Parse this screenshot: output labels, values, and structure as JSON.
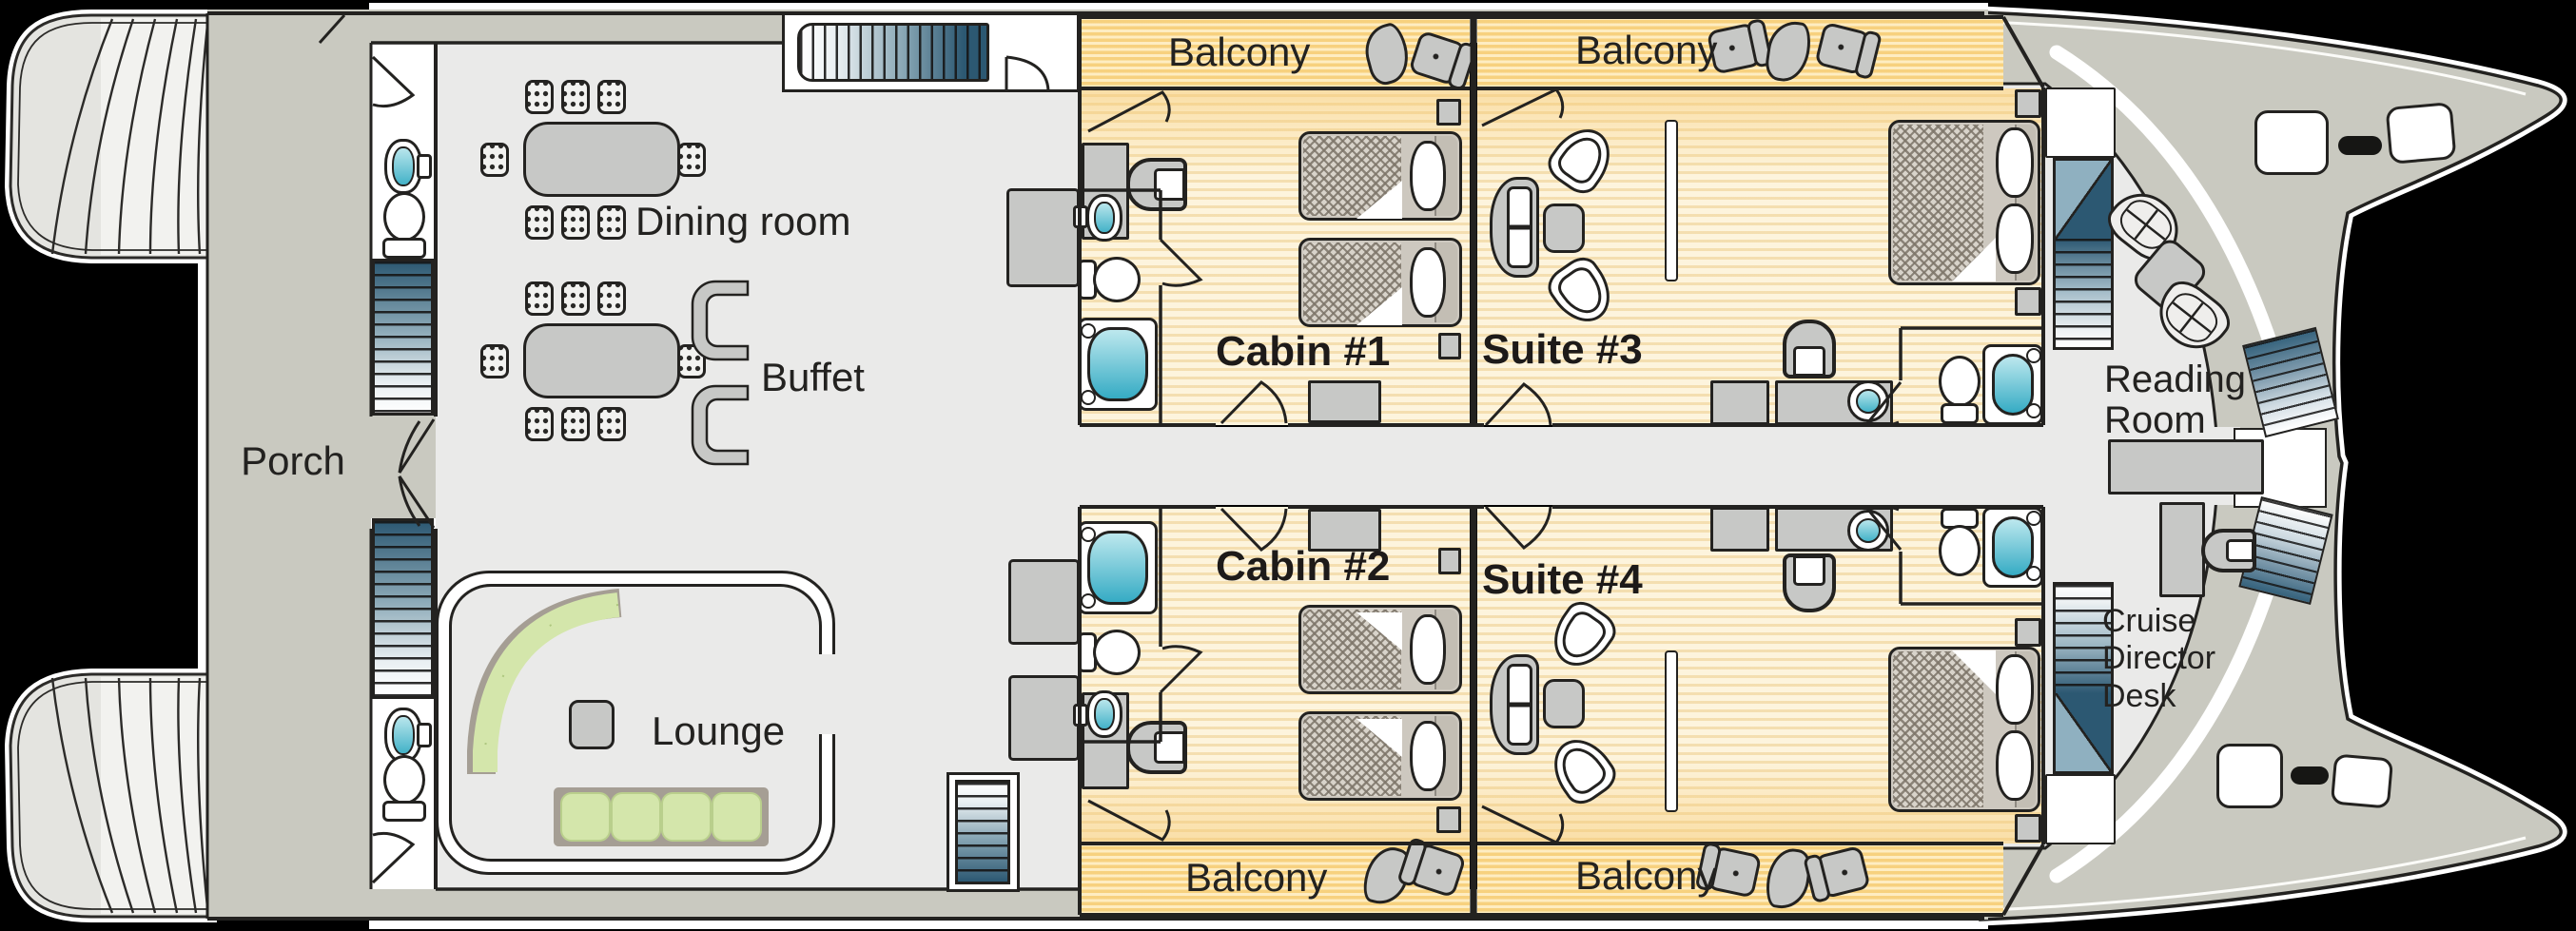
{
  "rooms": {
    "porch": "Porch",
    "dining_room": "Dining room",
    "buffet": "Buffet",
    "lounge": "Lounge",
    "cabin_1": "Cabin #1",
    "cabin_2": "Cabin #2",
    "suite_3": "Suite #3",
    "suite_4": "Suite #4",
    "reading_room": "Reading Room",
    "cruise_director_desk": "Cruise Director Desk"
  },
  "balconies": {
    "cabin_1": "Balcony",
    "suite_3": "Balcony",
    "cabin_2": "Balcony",
    "suite_4": "Balcony"
  },
  "colors": {
    "background": "#000000",
    "deck": "#c9c9c0",
    "hull": "#e4e4e0",
    "public_floor": "#eaeae9",
    "cabin_floor": "#fdf4dd",
    "balcony_floor": "#fbdf9e",
    "water_fixture": "#43b2c8",
    "stairs_dark": "#2c5872",
    "sofa_green": "#d4e6ab",
    "furniture_gray": "#c7c8c6",
    "outline": "#232220"
  },
  "symbols": {
    "staircase": "gradient-tread-strip",
    "bed": "chevron-mattress-with-pillow",
    "toilet": "tank-and-bowl",
    "sink": "cyan-basin",
    "bathtub": "cyan-rounded-tub",
    "dining_chair": "nine-dot-square",
    "deck_chair": "four-dot-square-with-back",
    "lounger": "bean-shape",
    "door": "leaf-and-swing-arc"
  }
}
